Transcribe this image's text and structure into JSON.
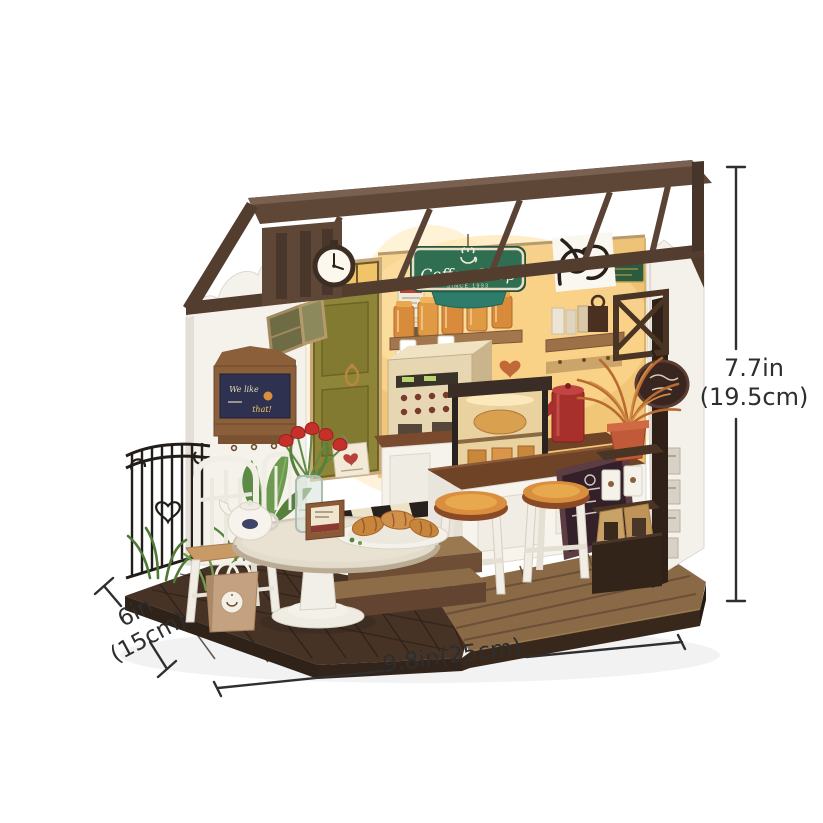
{
  "page": {
    "background": "#ffffff",
    "description": "Miniature DIY coffee shop dollhouse product photo with dimension arrows"
  },
  "product": {
    "name": "miniature-coffee-shop-dollhouse",
    "sign": {
      "title": "Coffee Shop",
      "subtitle": "SINCE 1993"
    },
    "blackboard": {
      "line1": "We like",
      "line2": "that!"
    }
  },
  "dimensions": {
    "height": {
      "value": "7.7in",
      "metric": "(19.5cm)"
    },
    "depth": {
      "value": "6in",
      "metric": "(15cm)"
    },
    "width": {
      "value": "9.8in(25cm)"
    }
  },
  "colors": {
    "sign_green": "#2f6e50",
    "roof_brown": "#5f4737",
    "wall_white": "#f5f2ec",
    "interior_glow": "#f2c469",
    "base_tile_brown": "#463326",
    "plank_brown": "#8a6947",
    "stool_top_orange": "#d98f3e",
    "accent_red": "#c5302a",
    "dimension_line": "#2f2f2f"
  }
}
